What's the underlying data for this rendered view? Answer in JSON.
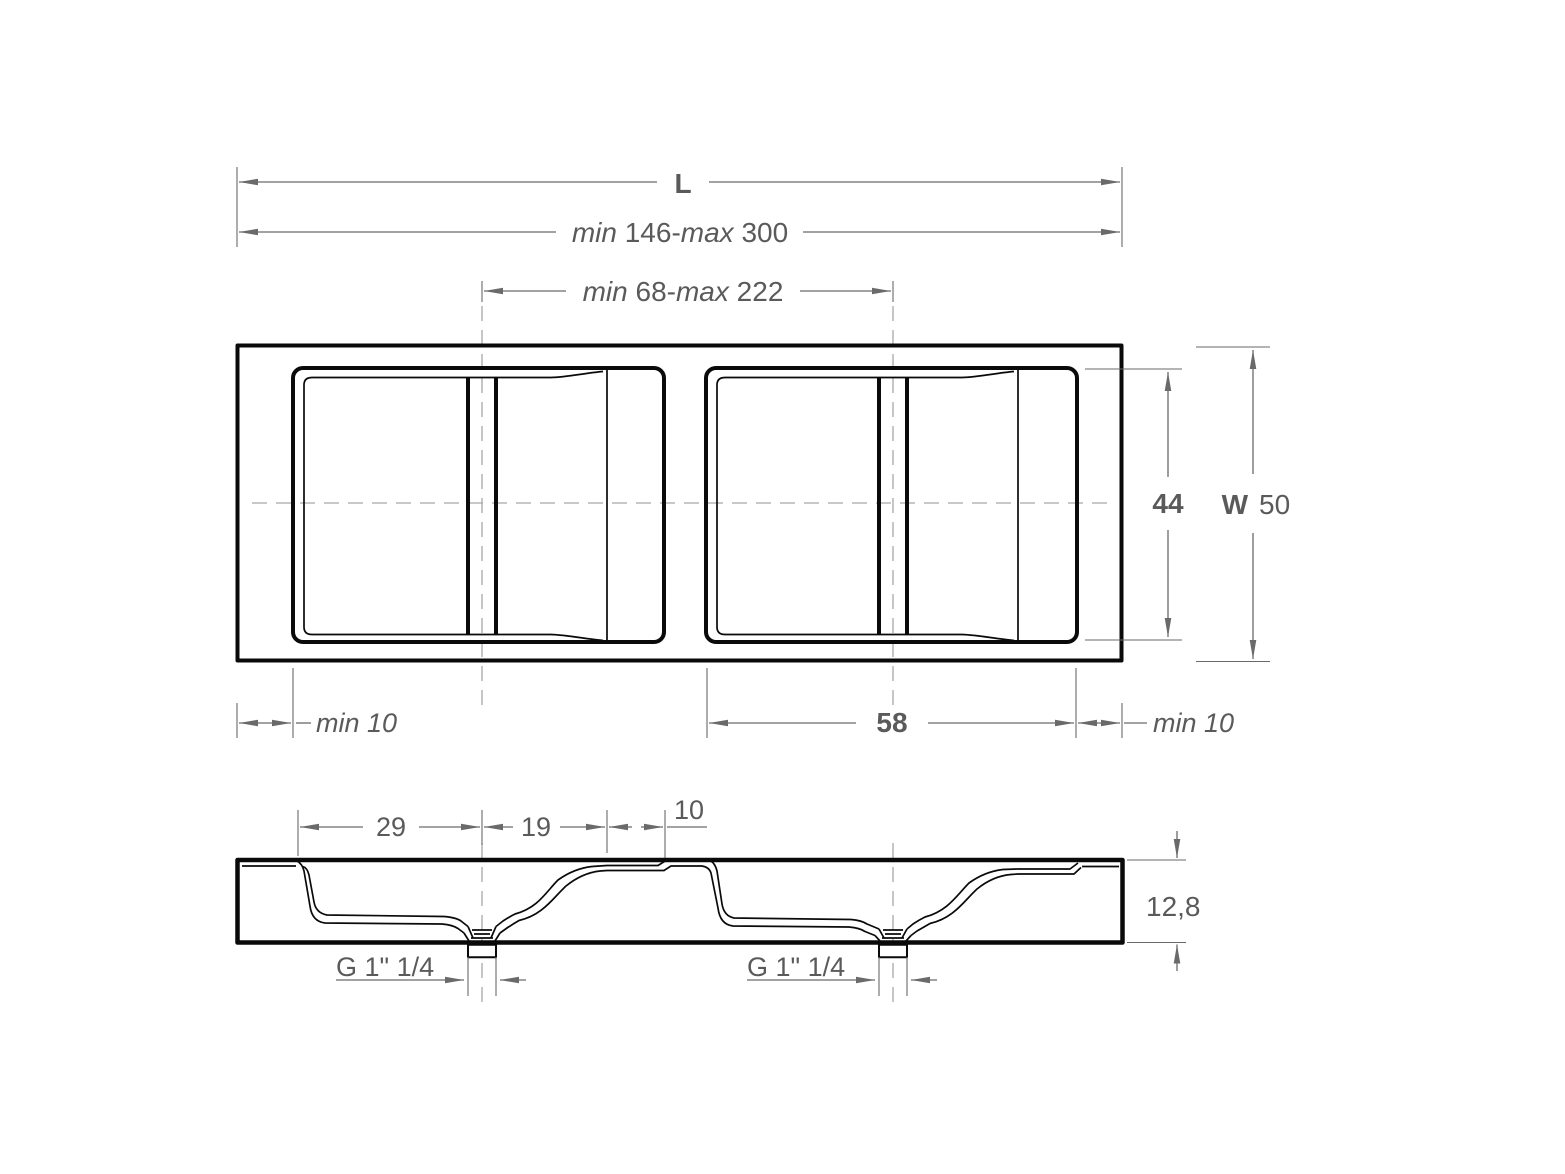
{
  "drawing": {
    "kind": "dimensioned technical drawing, plan view and section view of a double-basin countertop",
    "colors": {
      "geometry_line": "#0a0a0a",
      "dimension_line": "#6a6a6a",
      "dimension_text": "#5a5a5a",
      "centerline": "#a8a8a8",
      "background": "#ffffff"
    }
  },
  "plan_view": {
    "overall_length_label": "L",
    "length_range": {
      "min_word": "min ",
      "min_value": "146",
      "dash": "-",
      "max_word": "max ",
      "max_value": "300"
    },
    "drain_spacing_range": {
      "min_word": "min ",
      "min_value": "68",
      "dash": "-",
      "max_word": "max ",
      "max_value": "222"
    },
    "basin_inner_width": "44",
    "overall_width_label": "W",
    "overall_width_value": "50",
    "left_margin": "min 10",
    "basin_length": "58",
    "right_margin": "min 10"
  },
  "section_view": {
    "edge_to_drain": "29",
    "drain_to_deck": "19",
    "deck_width": "10",
    "thickness": "12,8",
    "left_drain_thread": "G 1\" 1/4",
    "right_drain_thread": "G 1\" 1/4"
  }
}
